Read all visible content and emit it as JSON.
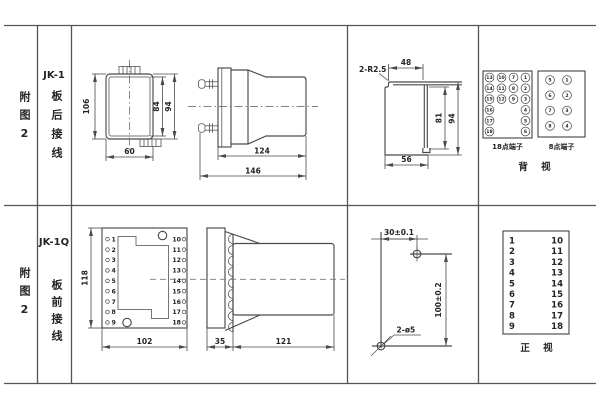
{
  "sheet": {
    "bg": "#ffffff",
    "line_color": "#4a4a4a"
  },
  "rear": {
    "fig_label": "附图2",
    "model": "JK-1",
    "wiring": "板后接线",
    "front_view": {
      "dim_height": "106",
      "dim_inner_height": "84",
      "dim_outer_height": "94",
      "dim_width": "60"
    },
    "side_view": {
      "dim_body_depth": "124",
      "dim_total_depth": "146"
    },
    "cutout": {
      "corner_radius": "2-R2.5",
      "dim_top_width": "48",
      "dim_inner_height": "81",
      "dim_outer_height": "94",
      "dim_bottom_width": "56"
    },
    "terminal18": {
      "label": "18点端子",
      "grid": [
        [
          "13",
          "10",
          "7",
          "1"
        ],
        [
          "14",
          "11",
          "8",
          "2"
        ],
        [
          "15",
          "12",
          "9",
          "3"
        ]
      ],
      "left_col": [
        "16",
        "17",
        "18"
      ],
      "right_col": [
        "4",
        "5",
        "6"
      ]
    },
    "terminal8": {
      "label": "8点端子",
      "left_col": [
        "5",
        "6",
        "7",
        "8"
      ],
      "right_col": [
        "1",
        "2",
        "3",
        "4"
      ]
    },
    "view_label": "背 视"
  },
  "front": {
    "fig_label": "附图2",
    "model": "JK-1Q",
    "wiring": "板前接线",
    "front_view": {
      "dim_height": "118",
      "dim_width": "102",
      "left_terminals": [
        "1",
        "2",
        "3",
        "4",
        "5",
        "6",
        "7",
        "8",
        "9"
      ],
      "right_terminals": [
        "10",
        "11",
        "12",
        "13",
        "14",
        "15",
        "16",
        "17",
        "18"
      ]
    },
    "side_view": {
      "dim_plate": "35",
      "dim_body": "121"
    },
    "drilling": {
      "dim_horizontal": "30±0.1",
      "dim_vertical": "100±0.2",
      "holes_label": "2-ø5"
    },
    "terminal_table": {
      "left": [
        "1",
        "2",
        "3",
        "4",
        "5",
        "6",
        "7",
        "8",
        "9"
      ],
      "right": [
        "10",
        "11",
        "12",
        "13",
        "14",
        "15",
        "16",
        "17",
        "18"
      ],
      "view_label": "正 视"
    }
  }
}
